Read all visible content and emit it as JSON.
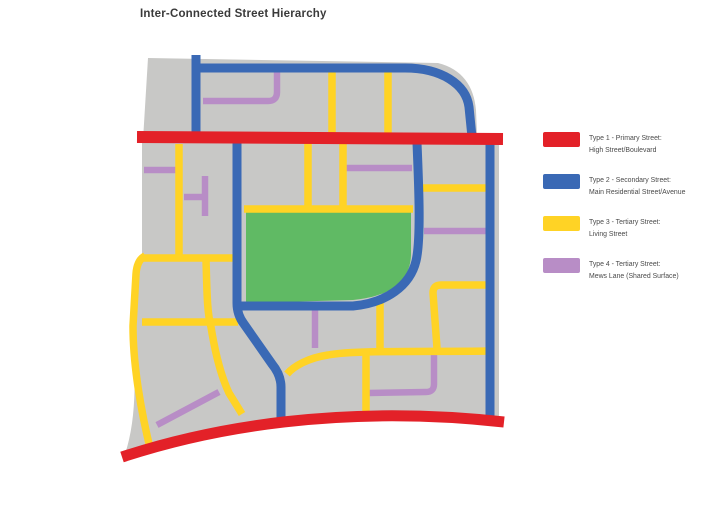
{
  "title": "Inter-Connected Street Hierarchy",
  "map": {
    "colors": {
      "base": "#c8c8c6",
      "park": "#60ba64",
      "primary": "#e32128",
      "secondary": "#3a69b5",
      "tertiary_living": "#ffd325",
      "tertiary_mews": "#b88dc6"
    }
  },
  "legend": {
    "items": [
      {
        "color": "#e32128",
        "line1": "Type 1 - Primary Street:",
        "line2": "High Street/Boulevard"
      },
      {
        "color": "#3a69b5",
        "line1": "Type 2 - Secondary Street:",
        "line2": "Main Residential Street/Avenue"
      },
      {
        "color": "#ffd325",
        "line1": "Type 3 - Tertiary Street:",
        "line2": "Living Street"
      },
      {
        "color": "#b88dc6",
        "line1": "Type 4 - Tertiary Street:",
        "line2": "Mews Lane (Shared Surface)"
      }
    ]
  }
}
